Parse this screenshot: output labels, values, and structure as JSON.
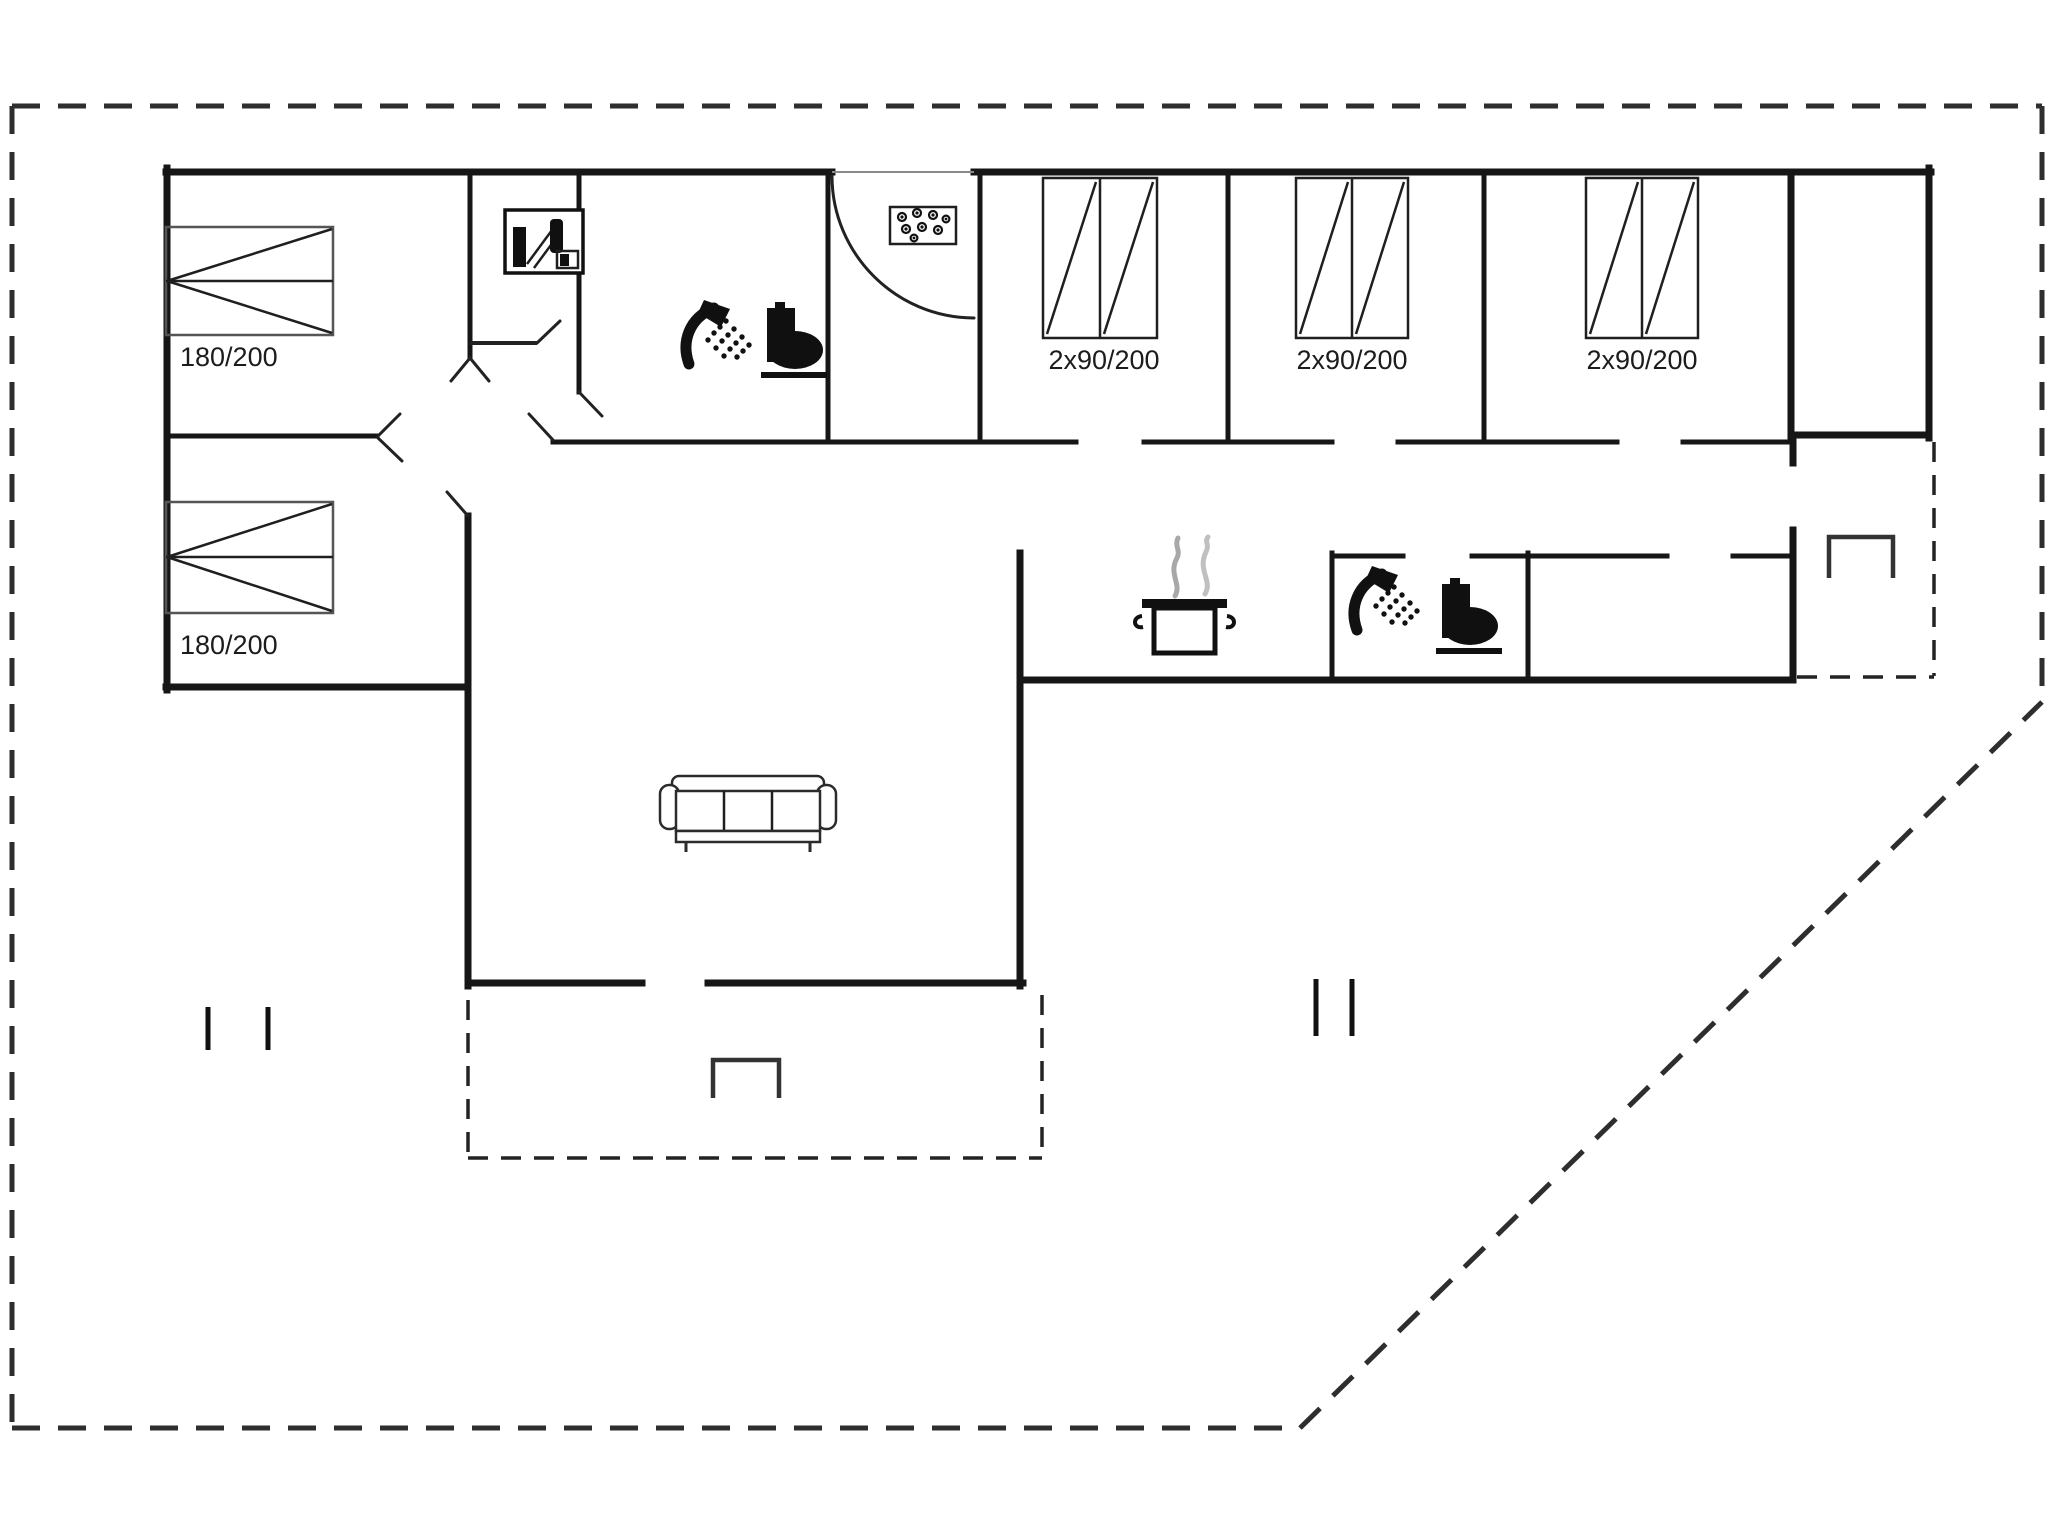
{
  "plan": {
    "labels": {
      "bed_1": "180/200",
      "bed_2": "180/200",
      "wardrobe_1": "2x90/200",
      "wardrobe_2": "2x90/200",
      "wardrobe_3": "2x90/200"
    },
    "icons": [
      "double-bed-icon",
      "double-wardrobe-icon",
      "washing-machine-icon",
      "dot-tray-icon",
      "entrance-door-swing",
      "shower-icon",
      "toilet-icon",
      "cooking-pot-icon",
      "sofa-icon",
      "grill-icon",
      "window-tick-marks"
    ],
    "colors": {
      "background": "#ffffff",
      "walls": "#161616",
      "furniture": "#1f1f1f",
      "muted_gray": "#8a8a8a",
      "boundary_dash": "#2e2e2e"
    }
  }
}
